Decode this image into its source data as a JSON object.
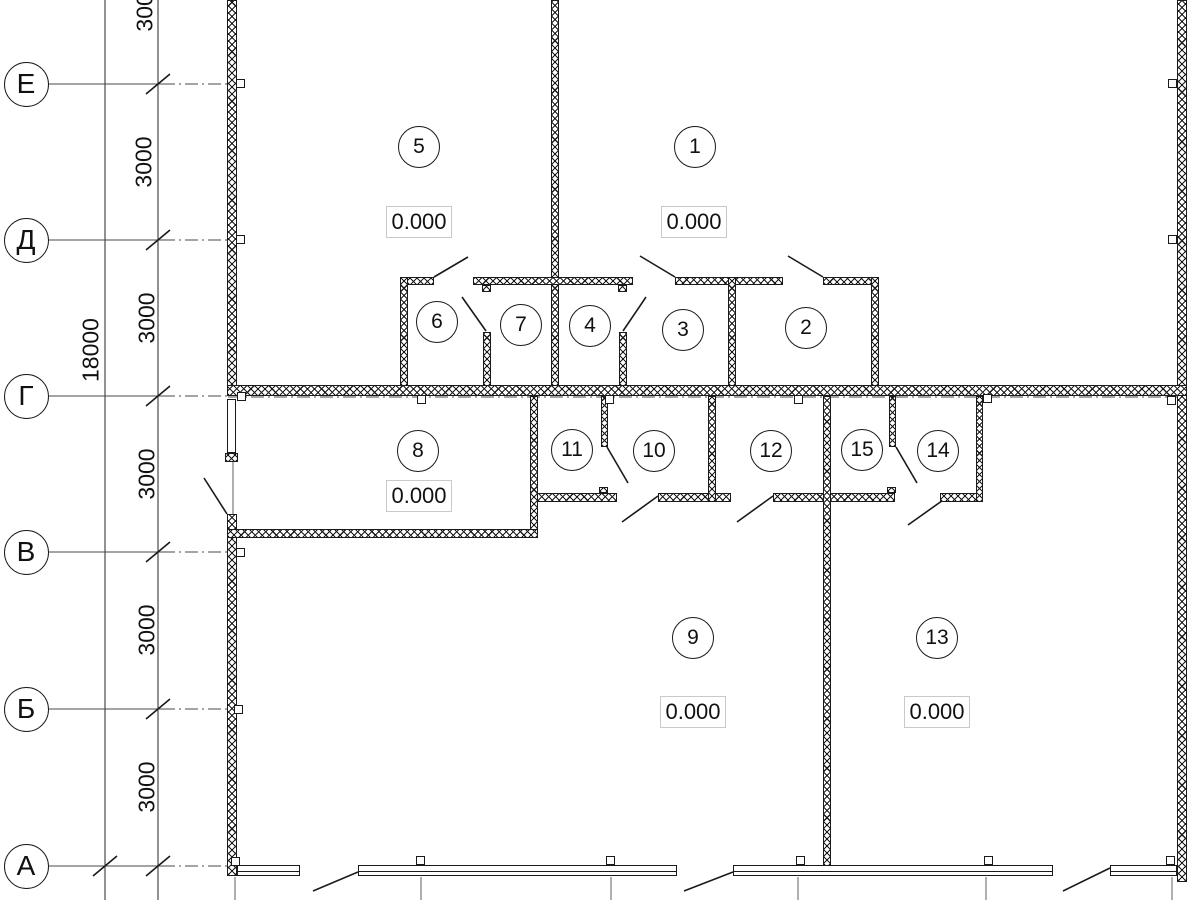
{
  "drawing_title": "floor-plan",
  "colors": {
    "line": "#1a1a1a",
    "axis_line": "#4a4a4a",
    "grid_line": "#7a7a7a",
    "label_border": "#c9c9c9",
    "bg": "#ffffff"
  },
  "axes": {
    "circle_x": 26,
    "circle_d": 45,
    "dim_line_total_x": 105,
    "dim_line_seg_x": 158,
    "letters": [
      {
        "label": "Е",
        "y": 84
      },
      {
        "label": "Д",
        "y": 240
      },
      {
        "label": "Г",
        "y": 396
      },
      {
        "label": "В",
        "y": 552
      },
      {
        "label": "Б",
        "y": 709
      },
      {
        "label": "А",
        "y": 866
      }
    ],
    "segment_labels": [
      {
        "text": "3000",
        "x": 145,
        "y": 6
      },
      {
        "text": "3000",
        "x": 144,
        "y": 162
      },
      {
        "text": "3000",
        "x": 147,
        "y": 318
      },
      {
        "text": "3000",
        "x": 147,
        "y": 474
      },
      {
        "text": "3000",
        "x": 147,
        "y": 630
      },
      {
        "text": "3000",
        "x": 147,
        "y": 787
      }
    ],
    "total_label": {
      "text": "18000",
      "x": 91,
      "y": 350
    }
  },
  "rooms": [
    {
      "number": "1",
      "cx": 695,
      "cy": 147,
      "elevation": {
        "text": "0.000",
        "cx": 694,
        "cy": 222
      }
    },
    {
      "number": "2",
      "cx": 806,
      "cy": 328
    },
    {
      "number": "3",
      "cx": 683,
      "cy": 330
    },
    {
      "number": "4",
      "cx": 590,
      "cy": 326
    },
    {
      "number": "5",
      "cx": 419,
      "cy": 147,
      "elevation": {
        "text": "0.000",
        "cx": 419,
        "cy": 222
      }
    },
    {
      "number": "6",
      "cx": 437,
      "cy": 322
    },
    {
      "number": "7",
      "cx": 521,
      "cy": 325
    },
    {
      "number": "8",
      "cx": 418,
      "cy": 451,
      "elevation": {
        "text": "0.000",
        "cx": 419,
        "cy": 496
      }
    },
    {
      "number": "9",
      "cx": 693,
      "cy": 638,
      "elevation": {
        "text": "0.000",
        "cx": 693,
        "cy": 712
      }
    },
    {
      "number": "10",
      "cx": 654,
      "cy": 451
    },
    {
      "number": "11",
      "cx": 572,
      "cy": 450
    },
    {
      "number": "12",
      "cx": 771,
      "cy": 451
    },
    {
      "number": "13",
      "cx": 937,
      "cy": 638,
      "elevation": {
        "text": "0.000",
        "cx": 937,
        "cy": 712
      }
    },
    {
      "number": "14",
      "cx": 938,
      "cy": 451
    },
    {
      "number": "15",
      "cx": 862,
      "cy": 450
    }
  ],
  "geometry": {
    "walls": [
      {
        "name": "left-wall-upper",
        "x": 227,
        "y": 0,
        "w": 10,
        "h": 396
      },
      {
        "name": "left-wall-end-cap",
        "x": 225,
        "y": 453,
        "w": 13,
        "h": 9
      },
      {
        "name": "left-wall-lower",
        "x": 227,
        "y": 514,
        "w": 10,
        "h": 362
      },
      {
        "name": "right-wall",
        "x": 1177,
        "y": 0,
        "w": 10,
        "h": 882
      },
      {
        "name": "wall-rooms-5-1",
        "x": 551,
        "y": 0,
        "w": 8,
        "h": 386
      },
      {
        "name": "wall-axis-g",
        "x": 227,
        "y": 385,
        "w": 960,
        "h": 11
      },
      {
        "name": "band-top-wall-a",
        "x": 400,
        "y": 277,
        "w": 34,
        "h": 8
      },
      {
        "name": "band-top-wall-b",
        "x": 473,
        "y": 277,
        "w": 160,
        "h": 8
      },
      {
        "name": "band-top-wall-c",
        "x": 675,
        "y": 277,
        "w": 108,
        "h": 8
      },
      {
        "name": "band-top-wall-d",
        "x": 823,
        "y": 277,
        "w": 56,
        "h": 8
      },
      {
        "name": "room6-left-wall",
        "x": 400,
        "y": 277,
        "w": 8,
        "h": 109
      },
      {
        "name": "stub-6-7-top",
        "x": 482,
        "y": 285,
        "w": 9,
        "h": 7
      },
      {
        "name": "wall-6-7-lower",
        "x": 483,
        "y": 332,
        "w": 8,
        "h": 54
      },
      {
        "name": "stub-4-3-top",
        "x": 618,
        "y": 285,
        "w": 9,
        "h": 7
      },
      {
        "name": "wall-4-3-lower",
        "x": 619,
        "y": 332,
        "w": 8,
        "h": 54
      },
      {
        "name": "wall-3-2",
        "x": 728,
        "y": 277,
        "w": 8,
        "h": 109
      },
      {
        "name": "room2-right-wall",
        "x": 871,
        "y": 277,
        "w": 8,
        "h": 109
      },
      {
        "name": "wall-8-11",
        "x": 530,
        "y": 396,
        "w": 8,
        "h": 142
      },
      {
        "name": "room8-bottom-wall",
        "x": 227,
        "y": 529,
        "w": 311,
        "h": 9
      },
      {
        "name": "band2-bottom-wall-a",
        "x": 537,
        "y": 493,
        "w": 80,
        "h": 9
      },
      {
        "name": "band2-bottom-wall-b",
        "x": 658,
        "y": 493,
        "w": 73,
        "h": 9
      },
      {
        "name": "band2-bottom-wall-c",
        "x": 773,
        "y": 493,
        "w": 122,
        "h": 9
      },
      {
        "name": "band2-bottom-wall-d",
        "x": 940,
        "y": 493,
        "w": 43,
        "h": 9
      },
      {
        "name": "wall-11-10",
        "x": 601,
        "y": 396,
        "w": 7,
        "h": 51
      },
      {
        "name": "stub-11-10-bottom",
        "x": 599,
        "y": 487,
        "w": 9,
        "h": 6
      },
      {
        "name": "wall-10-12",
        "x": 708,
        "y": 396,
        "w": 8,
        "h": 106
      },
      {
        "name": "wall-9-13",
        "x": 823,
        "y": 396,
        "w": 8,
        "h": 470
      },
      {
        "name": "wall-15-14",
        "x": 889,
        "y": 396,
        "w": 7,
        "h": 51
      },
      {
        "name": "stub-15-14-bottom",
        "x": 887,
        "y": 487,
        "w": 9,
        "h": 6
      },
      {
        "name": "room14-right-wall",
        "x": 976,
        "y": 396,
        "w": 7,
        "h": 106
      }
    ],
    "windows": [
      {
        "name": "left-wall-pier-window",
        "x": 227,
        "y": 399,
        "w": 9,
        "h": 54,
        "mid": false
      },
      {
        "name": "window-sill-1",
        "x": 237,
        "y": 865,
        "w": 63,
        "h": 11,
        "mid": true
      },
      {
        "name": "window-sill-2",
        "x": 358,
        "y": 865,
        "w": 319,
        "h": 11,
        "mid": true
      },
      {
        "name": "window-sill-3",
        "x": 733,
        "y": 865,
        "w": 320,
        "h": 11,
        "mid": true
      },
      {
        "name": "window-sill-4",
        "x": 1110,
        "y": 865,
        "w": 67,
        "h": 11,
        "mid": true
      }
    ],
    "markers": [
      {
        "x": 236,
        "y": 79
      },
      {
        "x": 236,
        "y": 235
      },
      {
        "x": 237,
        "y": 392
      },
      {
        "x": 236,
        "y": 548
      },
      {
        "x": 234,
        "y": 705
      },
      {
        "x": 231,
        "y": 857
      },
      {
        "x": 1168,
        "y": 79
      },
      {
        "x": 1168,
        "y": 235
      },
      {
        "x": 1167,
        "y": 396
      },
      {
        "x": 417,
        "y": 395
      },
      {
        "x": 605,
        "y": 395
      },
      {
        "x": 794,
        "y": 395
      },
      {
        "x": 983,
        "y": 394
      },
      {
        "x": 416,
        "y": 856
      },
      {
        "x": 606,
        "y": 856
      },
      {
        "x": 796,
        "y": 856
      },
      {
        "x": 984,
        "y": 856
      },
      {
        "x": 1166,
        "y": 856
      }
    ],
    "door_leaves": [
      [
        434,
        277,
        468,
        257
      ],
      [
        675,
        277,
        640,
        256
      ],
      [
        823,
        277,
        788,
        256
      ],
      [
        462,
        297,
        486,
        331
      ],
      [
        646,
        297,
        623,
        331
      ],
      [
        607,
        447,
        628,
        483
      ],
      [
        896,
        447,
        917,
        483
      ],
      [
        658,
        496,
        622,
        522
      ],
      [
        773,
        496,
        737,
        522
      ],
      [
        946,
        498,
        908,
        525
      ],
      [
        227,
        514,
        204,
        478
      ],
      [
        358,
        872,
        313,
        891
      ],
      [
        733,
        872,
        684,
        891
      ],
      [
        1110,
        868,
        1063,
        891
      ]
    ],
    "axis_slashes": [
      [
        146,
        94,
        170,
        74
      ],
      [
        146,
        250,
        170,
        230
      ],
      [
        146,
        406,
        170,
        386
      ],
      [
        146,
        562,
        170,
        542
      ],
      [
        146,
        719,
        170,
        699
      ],
      [
        146,
        876,
        170,
        856
      ],
      [
        93,
        876,
        117,
        856
      ]
    ],
    "grid_lines": [
      {
        "x": 235,
        "y1": 877,
        "y2": 900
      },
      {
        "x": 421,
        "y1": 877,
        "y2": 900
      },
      {
        "x": 611,
        "y1": 877,
        "y2": 900
      },
      {
        "x": 798,
        "y1": 877,
        "y2": 900
      },
      {
        "x": 986,
        "y1": 877,
        "y2": 900
      },
      {
        "x": 1172,
        "y1": 877,
        "y2": 900
      },
      {
        "x": 233,
        "y1": 462,
        "y2": 514
      }
    ],
    "axis_line_solid_x": [
      48,
      162
    ],
    "axis_line_dashdot_x": [
      162,
      228
    ],
    "axis_g_through": [
      228,
      1187,
      397
    ]
  }
}
